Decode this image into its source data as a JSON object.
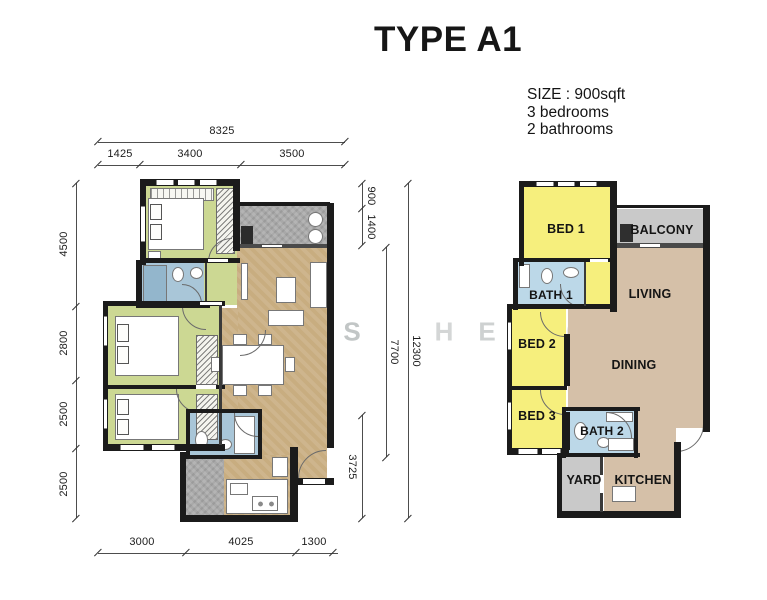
{
  "title": "TYPE A1",
  "info": {
    "size": "SIZE : 900sqft",
    "bedrooms": "3 bedrooms",
    "bathrooms": "2 bathrooms"
  },
  "watermark": {
    "letters": [
      "S",
      "H",
      "E",
      "N",
      "G"
    ]
  },
  "detailed_plan": {
    "dim_top_total": "8325",
    "dim_top_segments": [
      "1425",
      "3400",
      "3500"
    ],
    "dim_left": [
      "4500",
      "2800",
      "2500",
      "2500"
    ],
    "dim_right_top": [
      "900",
      "1400"
    ],
    "dim_right_mid": "7700",
    "dim_right_bottom": "3725",
    "dim_right_total": "12300",
    "dim_bottom": [
      "3000",
      "4025",
      "1300"
    ]
  },
  "simple_plan": {
    "rooms": [
      {
        "label": "BED 1",
        "color": "#f6ef7d"
      },
      {
        "label": "BALCONY",
        "color": "#c9c9c9"
      },
      {
        "label": "LIVING",
        "color": "#d5c0a8"
      },
      {
        "label": "BATH 1",
        "color": "#bcd8e8"
      },
      {
        "label": "BED 2",
        "color": "#f6ef7d"
      },
      {
        "label": "DINING",
        "color": "#d5c0a8"
      },
      {
        "label": "BED 3",
        "color": "#f6ef7d"
      },
      {
        "label": "BATH 2",
        "color": "#bcd8e8"
      },
      {
        "label": "YARD",
        "color": "#c9c9c9"
      },
      {
        "label": "KITCHEN",
        "color": "#d5c0a8"
      }
    ]
  },
  "colors": {
    "bedroom_green": "#ccd893",
    "living_tan": "#c8ad80",
    "bath_blue": "#a9c6d8",
    "balcony_gray": "#a8a8a8",
    "wall_black": "#1b1b1b",
    "simple_yellow": "#f6ef7d",
    "simple_tan": "#d5c0a8",
    "simple_gray": "#c9c9c9",
    "simple_blue": "#bcd8e8"
  }
}
